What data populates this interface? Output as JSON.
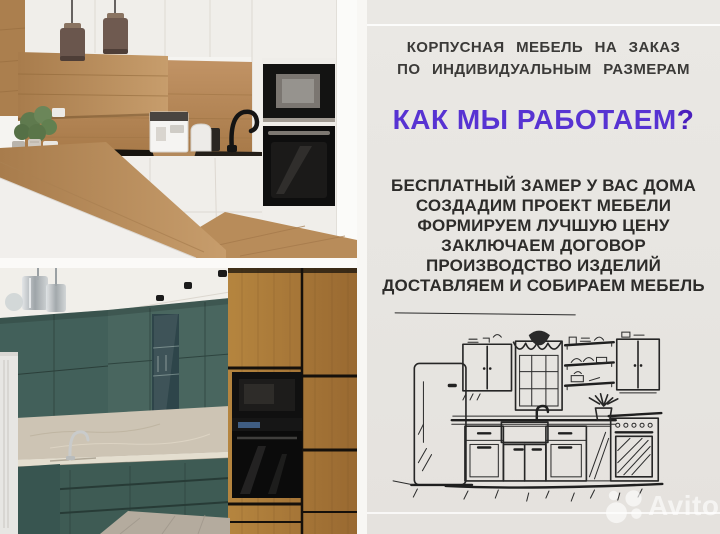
{
  "ad": {
    "heading_line1": "КОРПУСНАЯ МЕБЕЛЬ НА ЗАКАЗ",
    "heading_line2": "ПО ИНДИВИДУАЛЬНЫМ РАЗМЕРАМ",
    "question_heading": "КАК МЫ РАБОТАЕМ",
    "question_mark": "?",
    "steps": [
      "БЕСПЛАТНЫЙ ЗАМЕР У ВАС ДОМА",
      "СОЗДАДИМ ПРОЕКТ МЕБЕЛИ",
      "ФОРМИРУЕМ ЛУЧШУЮ ЦЕНУ",
      "ЗАКЛЮЧАЕМ ДОГОВОР",
      "ПРОИЗВОДСТВО ИЗДЕЛИЙ",
      "ДОСТАВЛЯЕМ И СОБИРАЕМ МЕБЕЛЬ"
    ],
    "colors": {
      "accent_purple": "#5733d2",
      "question_mark_purple": "#4a1fbd",
      "heading_text": "#3b3a38",
      "body_text": "#2d2c2a",
      "panel_background": "#e7e5e1",
      "teal_cabinet": "#42605a",
      "oak_wood": "#b2803f"
    },
    "photos": [
      {
        "name": "white-oak-kitchen",
        "description": "white kitchen with oak wood panels, pendant lamps and black built-in appliances"
      },
      {
        "name": "teal-oak-kitchen",
        "description": "teal kitchen with oak tall units, beige stone backsplash and black built-in appliances"
      }
    ],
    "sketch": {
      "description": "hand-drawn ink sketch of a kitchen set with fridge, window, shelves and stove"
    }
  },
  "watermark": {
    "label": "Avito"
  }
}
